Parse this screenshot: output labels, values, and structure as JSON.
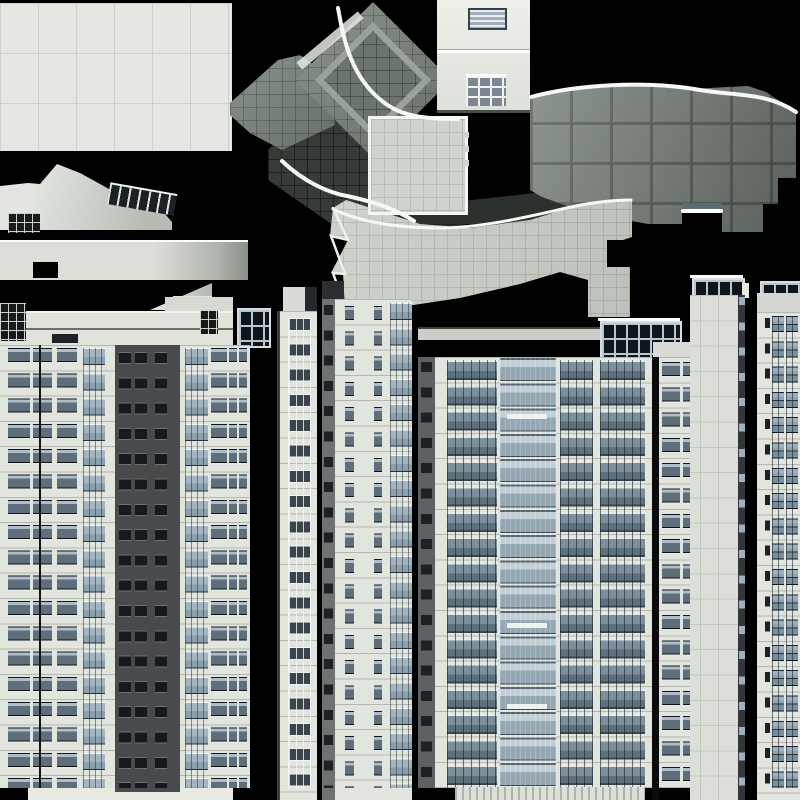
{
  "meta": {
    "kind": "texture-atlas",
    "subject": "building-facades-and-roof-tiles",
    "canvas": {
      "width": 800,
      "height": 800,
      "background": "#000000"
    },
    "palette": {
      "roof_tile_light": "#e5e7e3",
      "roof_tile_mid": "#7e8780",
      "plaza_light": "#c9cec6",
      "plaza_dark": "#363b38",
      "wall_light": "#e2e5de",
      "glass_blue": "#8fa3b0",
      "dark_tower": "#494a4c",
      "white_line": "#ffffff"
    }
  },
  "curves": [
    {
      "name": "roof-curve-fan",
      "d": "M338,8 C344,42 352,80 386,104 C404,117 428,119 458,119",
      "w": 4,
      "c": "#f6f8f5"
    },
    {
      "name": "roof-curve-inner",
      "d": "M282,161 C305,183 330,193 347,196 C380,203 398,211 414,221",
      "w": 4,
      "c": "#f6f8f5"
    },
    {
      "name": "roof-curve-right",
      "d": "M531,97 C575,85 645,80 700,90 C735,96 766,92 796,112",
      "w": 4,
      "c": "#f6f8f5"
    },
    {
      "name": "plaza-top-edge",
      "d": "M333,209 C362,223 402,228 442,228 C492,227 542,213 576,206 C596,202 616,200 631,200",
      "w": 3,
      "c": "#f6f8f5"
    },
    {
      "name": "plaza-left-zigzag",
      "d": "M333,208 L348,240 L331,236 L345,274 L333,273 L346,310",
      "w": 2.5,
      "c": "#eef0ec"
    },
    {
      "name": "roof-step-line",
      "d": "M683,211 L721,211",
      "w": 4,
      "c": "#ffffff"
    }
  ],
  "regions": [
    {
      "name": "roof-panel-topleft",
      "cls": "tile-lg",
      "x": 0,
      "y": 3,
      "w": 232,
      "h": 148
    },
    {
      "name": "dark-plaza-field",
      "cls": "tile-dark",
      "x": 268,
      "y": 120,
      "w": 197,
      "h": 112,
      "clip": "0px 30px,30px 0px,197px 0px,197px 112px,75px 112px,0px 60px"
    },
    {
      "name": "dark-shadow-band",
      "cls": "",
      "x": 400,
      "y": 188,
      "w": 180,
      "h": 36,
      "bg": "#2c312e",
      "clip": "0px 20px,180px 0px,180px 36px,0px 36px"
    },
    {
      "name": "roof-wedge",
      "cls": "roof-light",
      "x": 0,
      "y": 164,
      "w": 172,
      "h": 66,
      "clip": "0px 22px,28px 19px,40px 20px,57px 0px,80px 9px,100px 20px,125px 34px,150px 43px,165px 50px,172px 58px,172px 66px,0px 66px"
    },
    {
      "name": "roof-wedge-clerestory",
      "cls": "mullion-strip",
      "x": 108,
      "y": 188,
      "w": 68,
      "h": 20,
      "rot": 10
    },
    {
      "name": "roof-dark-window-piece",
      "cls": "win-grid-sm",
      "x": 8,
      "y": 213,
      "w": 32,
      "h": 20
    },
    {
      "name": "roof-long-bar",
      "cls": "bar",
      "x": 0,
      "y": 240,
      "w": 248,
      "h": 38
    },
    {
      "name": "roof-bar-notch",
      "cls": "",
      "x": 33,
      "y": 262,
      "w": 25,
      "h": 16,
      "bg": "#000"
    },
    {
      "name": "roof-wedge-2",
      "cls": "roof-light",
      "x": 150,
      "y": 282,
      "w": 62,
      "h": 28,
      "clip": "0px 28px,62px 1px,62px 28px"
    },
    {
      "name": "roof-wedge-2-cap",
      "cls": "",
      "x": 173,
      "y": 296,
      "w": 39,
      "h": 14,
      "bg": "#dfe3dc"
    },
    {
      "name": "roof-wedge-2-window",
      "cls": "",
      "x": 186,
      "y": 299,
      "w": 22,
      "h": 11,
      "bg": "#aebfca"
    },
    {
      "name": "diamond-tail",
      "cls": "tile-mid",
      "x": 230,
      "y": 55,
      "w": 105,
      "h": 95,
      "clip": "0px 48px,48px 5px,70px 0px,105px 25px,105px 70px,52px 95px,20px 78px,0px 60px"
    },
    {
      "name": "diamond-base",
      "cls": "tile-mid",
      "x": 295,
      "y": 2,
      "w": 156,
      "h": 156,
      "clip": "50% 0%,100% 50%,50% 100%,0% 50%"
    },
    {
      "name": "diamond-ring",
      "cls": "ring",
      "x": 315,
      "y": 22,
      "w": 116,
      "h": 116,
      "clip": "50% 0%,100% 50%,50% 100%,0% 50%"
    },
    {
      "name": "diamond-inner",
      "cls": "tile-mid2",
      "x": 324,
      "y": 31,
      "w": 98,
      "h": 98,
      "clip": "50% 0%,100% 50%,50% 100%,0% 50%"
    },
    {
      "name": "diamond-edge-highlight",
      "cls": "",
      "x": 290,
      "y": 36,
      "w": 80,
      "h": 9,
      "rot": -40,
      "bg": "rgba(228,231,226,0.85)"
    },
    {
      "name": "right-roof-field",
      "cls": "tile-bigsq",
      "x": 530,
      "y": 82,
      "w": 266,
      "h": 152,
      "clip": "0px 16px,35px 7px,95px 2px,160px 7px,218px 4px,236px 10px,266px 30px,266px 96px,248px 96px,248px 122px,233px 122px,233px 150px,192px 150px,192px 128px,152px 128px,152px 142px,118px 142px,80px 135px,40px 125px,12px 115px,0px 108px"
    },
    {
      "name": "right-roof-blue-sliver",
      "cls": "",
      "x": 683,
      "y": 203,
      "w": 38,
      "h": 6,
      "bg": "#5c6b76"
    },
    {
      "name": "central-plaza",
      "cls": "tile-plaza",
      "x": 330,
      "y": 196,
      "w": 302,
      "h": 121,
      "clip": "3px 12px,16px 4px,90px 28px,140px 32px,200px 24px,245px 10px,302px 3px,302px 41px,293px 44px,277px 44px,277px 71px,300px 71px,300px 121px,258px 121px,258px 84px,230px 76px,190px 88px,130px 102px,70px 111px,15px 114px,13px 78px,1px 77px,18px 44px,0px 40px"
    },
    {
      "name": "plaza-square",
      "cls": "plaza-card",
      "x": 368,
      "y": 116,
      "w": 94,
      "h": 93
    },
    {
      "name": "plaza-square-tabs",
      "cls": "",
      "x": 463,
      "y": 132,
      "w": 6,
      "h": 40,
      "bg": "repeating-linear-gradient(180deg,#cfd3cb 0 6px,transparent 6px 14px)"
    },
    {
      "name": "white-building",
      "cls": "whitebldg",
      "x": 437,
      "y": 0,
      "w": 93,
      "h": 110
    },
    {
      "name": "white-building-seam",
      "cls": "seam",
      "x": 437,
      "y": 49,
      "w": 93,
      "h": 3
    },
    {
      "name": "white-building-louver-window",
      "cls": "louver",
      "x": 468,
      "y": 8,
      "w": 35,
      "h": 18
    },
    {
      "name": "white-building-lower-window",
      "cls": "win-grid",
      "x": 466,
      "y": 74,
      "w": 40,
      "h": 30
    },
    {
      "name": "leftblock-parapet-topright",
      "cls": "z10",
      "x": 165,
      "y": 297,
      "w": 68,
      "h": 16,
      "bg": "#d5d9d2"
    },
    {
      "name": "leftblock-parapet",
      "cls": "z10",
      "x": 0,
      "y": 311,
      "w": 233,
      "h": 34,
      "bg": "#dfe3dc",
      "bt": "2px solid #f2f4f0"
    },
    {
      "name": "leftblock-parapet-line",
      "cls": "z10",
      "x": 0,
      "y": 328,
      "w": 233,
      "h": 2,
      "bg": "#6a6e67"
    },
    {
      "name": "leftblock-grid-left",
      "cls": "win-grid-sm z10",
      "x": 0,
      "y": 303,
      "w": 26,
      "h": 38
    },
    {
      "name": "leftblock-grid-right",
      "cls": "win-grid-sm z10",
      "x": 200,
      "y": 310,
      "w": 18,
      "h": 24
    },
    {
      "name": "leftblock-dark-strip",
      "cls": "z10",
      "x": 52,
      "y": 334,
      "w": 26,
      "h": 9,
      "bg": "#1e2226"
    },
    {
      "name": "glassbox-small",
      "cls": "glass-grid z10",
      "x": 237,
      "y": 308,
      "w": 30,
      "h": 36
    },
    {
      "name": "leftblock-wall",
      "cls": "wall z10",
      "x": 0,
      "y": 345,
      "w": 250,
      "h": 443
    },
    {
      "name": "leftblock-ground",
      "cls": "z10",
      "x": 28,
      "y": 788,
      "w": 205,
      "h": 12,
      "bg": "#e8eae3"
    },
    {
      "name": "leftblock-wincol-1",
      "cls": "win-a z10",
      "x": 8,
      "y": 348,
      "w": 22,
      "h": 440
    },
    {
      "name": "leftblock-wincol-2",
      "cls": "win-a z10",
      "x": 33,
      "y": 348,
      "w": 19,
      "h": 440
    },
    {
      "name": "leftblock-pipe",
      "cls": "z10",
      "x": 39,
      "y": 345,
      "w": 2,
      "h": 443,
      "bg": "#141414"
    },
    {
      "name": "leftblock-wincol-3",
      "cls": "win-a z10",
      "x": 57,
      "y": 348,
      "w": 20,
      "h": 440
    },
    {
      "name": "leftblock-balcony-col",
      "cls": "win-glass z10",
      "x": 83,
      "y": 348,
      "w": 22,
      "h": 440
    },
    {
      "name": "dark-tower-wall",
      "cls": "z10",
      "x": 115,
      "y": 345,
      "w": 65,
      "h": 447,
      "bg": "#494a4c"
    },
    {
      "name": "dark-tower-wincol-1",
      "cls": "win-dark z10",
      "x": 119,
      "y": 352,
      "w": 12,
      "h": 436
    },
    {
      "name": "dark-tower-wincol-2",
      "cls": "win-dark z10",
      "x": 135,
      "y": 352,
      "w": 12,
      "h": 436
    },
    {
      "name": "dark-tower-wincol-3",
      "cls": "win-dark z10",
      "x": 155,
      "y": 352,
      "w": 12,
      "h": 436
    },
    {
      "name": "leftblock-balcony-col-2",
      "cls": "win-glass z10",
      "x": 185,
      "y": 348,
      "w": 23,
      "h": 440
    },
    {
      "name": "leftblock-wincol-4",
      "cls": "win-a z10",
      "x": 211,
      "y": 348,
      "w": 16,
      "h": 440
    },
    {
      "name": "narrowcol-win-1",
      "cls": "win-a z10",
      "x": 229,
      "y": 348,
      "w": 8,
      "h": 440
    },
    {
      "name": "narrowcol-win-2",
      "cls": "win-a z10",
      "x": 239,
      "y": 348,
      "w": 8,
      "h": 440
    },
    {
      "name": "midcol1-parapet",
      "cls": "z10",
      "x": 283,
      "y": 287,
      "w": 22,
      "h": 24,
      "bg": "#d8dcd5"
    },
    {
      "name": "midcol1-parapet-dark",
      "cls": "z10",
      "x": 305,
      "y": 287,
      "w": 12,
      "h": 24,
      "bg": "#24282b"
    },
    {
      "name": "midcol1-wall",
      "cls": "wall z10",
      "x": 277,
      "y": 311,
      "w": 40,
      "h": 489
    },
    {
      "name": "midcol1-edge",
      "cls": "z10",
      "x": 277,
      "y": 311,
      "w": 3,
      "h": 489,
      "bg": "#3a3e40"
    },
    {
      "name": "midcol1-wincol",
      "cls": "win-frame z10",
      "x": 288,
      "y": 318,
      "w": 21,
      "h": 470
    },
    {
      "name": "midcol2-top-dark",
      "cls": "z10",
      "x": 322,
      "y": 281,
      "w": 22,
      "h": 20,
      "bg": "#2a2e30"
    },
    {
      "name": "midcol2-wall",
      "cls": "wall z10",
      "x": 322,
      "y": 299,
      "w": 90,
      "h": 501
    },
    {
      "name": "midcol2-left-strip",
      "cls": "z10",
      "x": 322,
      "y": 299,
      "w": 13,
      "h": 501,
      "bg": "#6e7272"
    },
    {
      "name": "midcol2-left-windows",
      "cls": "win-dark-sm z10",
      "x": 324,
      "y": 305,
      "w": 9,
      "h": 483
    },
    {
      "name": "midcol2-wincol-1",
      "cls": "win-a z10",
      "x": 345,
      "y": 306,
      "w": 9,
      "h": 482
    },
    {
      "name": "midcol2-wincol-2",
      "cls": "win-a z10",
      "x": 374,
      "y": 306,
      "w": 8,
      "h": 482
    },
    {
      "name": "midcol2-balcony-col",
      "cls": "win-glass z10",
      "x": 390,
      "y": 303,
      "w": 22,
      "h": 485
    },
    {
      "name": "bigtower-roof-strip",
      "cls": "z10",
      "x": 418,
      "y": 327,
      "w": 183,
      "h": 11,
      "bg": "#c9cec7",
      "bt": "2px solid #3c3f3c"
    },
    {
      "name": "glassbox-top-line",
      "cls": "z10",
      "x": 598,
      "y": 318,
      "w": 82,
      "h": 3,
      "bg": "#fff"
    },
    {
      "name": "glassbox-large",
      "cls": "glass-grid z10",
      "x": 600,
      "y": 321,
      "w": 78,
      "h": 36
    },
    {
      "name": "bigtower-parapet-right",
      "cls": "z10",
      "x": 653,
      "y": 342,
      "w": 44,
      "h": 15,
      "bg": "#d7dbd4"
    },
    {
      "name": "bigtower-wall",
      "cls": "wall z10",
      "x": 418,
      "y": 357,
      "w": 279,
      "h": 431
    },
    {
      "name": "bigtower-left-dark",
      "cls": "z10",
      "x": 418,
      "y": 357,
      "w": 17,
      "h": 431,
      "bg": "#5d6163"
    },
    {
      "name": "bigtower-left-windows",
      "cls": "win-dark-sm z10",
      "x": 421,
      "y": 362,
      "w": 11,
      "h": 424
    },
    {
      "name": "bigtower-bay-1",
      "cls": "bay-glass z10",
      "x": 447,
      "y": 360,
      "w": 50,
      "h": 428
    },
    {
      "name": "bigtower-atrium",
      "cls": "atrium z10",
      "x": 500,
      "y": 358,
      "w": 56,
      "h": 430
    },
    {
      "name": "bigtower-bay-2",
      "cls": "bay-glass z10",
      "x": 560,
      "y": 360,
      "w": 33,
      "h": 428
    },
    {
      "name": "bigtower-bay-3",
      "cls": "bay-glass z10",
      "x": 600,
      "y": 360,
      "w": 45,
      "h": 428
    },
    {
      "name": "bigtower-black-strip",
      "cls": "z10",
      "x": 652,
      "y": 357,
      "w": 7,
      "h": 443,
      "bg": "#0b0b0b"
    },
    {
      "name": "bigtower-wincol-r1",
      "cls": "win-a z10",
      "x": 662,
      "y": 362,
      "w": 18,
      "h": 426
    },
    {
      "name": "bigtower-wincol-r2",
      "cls": "win-a z10",
      "x": 683,
      "y": 362,
      "w": 12,
      "h": 426
    },
    {
      "name": "atrium-louver-1",
      "cls": "z10",
      "x": 507,
      "y": 414,
      "w": 40,
      "h": 5,
      "bg": "#eef1ee"
    },
    {
      "name": "atrium-louver-2",
      "cls": "z10",
      "x": 507,
      "y": 623,
      "w": 40,
      "h": 5,
      "bg": "#eef1ee"
    },
    {
      "name": "atrium-louver-3",
      "cls": "z10",
      "x": 507,
      "y": 704,
      "w": 40,
      "h": 5,
      "bg": "#eef1ee"
    },
    {
      "name": "bigtower-ground",
      "cls": "storefront z10",
      "x": 455,
      "y": 787,
      "w": 190,
      "h": 13
    },
    {
      "name": "rightplain-topline",
      "cls": "z10",
      "x": 690,
      "y": 275,
      "w": 53,
      "h": 3,
      "bg": "#fff"
    },
    {
      "name": "rightplain-glass-strip",
      "cls": "glass-grid z10",
      "x": 692,
      "y": 278,
      "w": 49,
      "h": 17
    },
    {
      "name": "rightplain-tab",
      "cls": "z10",
      "x": 742,
      "y": 283,
      "w": 7,
      "h": 15,
      "bg": "#e8eae4"
    },
    {
      "name": "rightplain-wall",
      "cls": "wall-plain z10",
      "x": 690,
      "y": 295,
      "w": 50,
      "h": 505
    },
    {
      "name": "rightplain-seam-1",
      "cls": "z10",
      "x": 700,
      "y": 295,
      "w": 1,
      "h": 505,
      "bg": "#c3c7bf"
    },
    {
      "name": "rightplain-seam-2",
      "cls": "z10",
      "x": 718,
      "y": 295,
      "w": 1,
      "h": 505,
      "bg": "#c3c7bf"
    },
    {
      "name": "rightplain-edge",
      "cls": "z10",
      "x": 738,
      "y": 295,
      "w": 7,
      "h": 505,
      "bg": "#33373a"
    },
    {
      "name": "rightplain-edge-tabs",
      "cls": "tab-col z10",
      "x": 739,
      "y": 297,
      "w": 6,
      "h": 503
    },
    {
      "name": "rightwin-mullion-top",
      "cls": "glass-grid z10",
      "x": 760,
      "y": 281,
      "w": 40,
      "h": 12
    },
    {
      "name": "rightwin-parapet",
      "cls": "z10",
      "x": 757,
      "y": 293,
      "w": 43,
      "h": 19,
      "bg": "#d3d7d0"
    },
    {
      "name": "rightwin-wall",
      "cls": "wall z10",
      "x": 757,
      "y": 312,
      "w": 43,
      "h": 488
    },
    {
      "name": "rightwin-slit",
      "cls": "win-dark-sm z10",
      "x": 765,
      "y": 318,
      "w": 5,
      "h": 470
    },
    {
      "name": "rightwin-wincol-1",
      "cls": "win-b z10",
      "x": 772,
      "y": 316,
      "w": 12,
      "h": 472
    },
    {
      "name": "rightwin-wincol-2",
      "cls": "win-b z10",
      "x": 786,
      "y": 316,
      "w": 12,
      "h": 472
    }
  ]
}
